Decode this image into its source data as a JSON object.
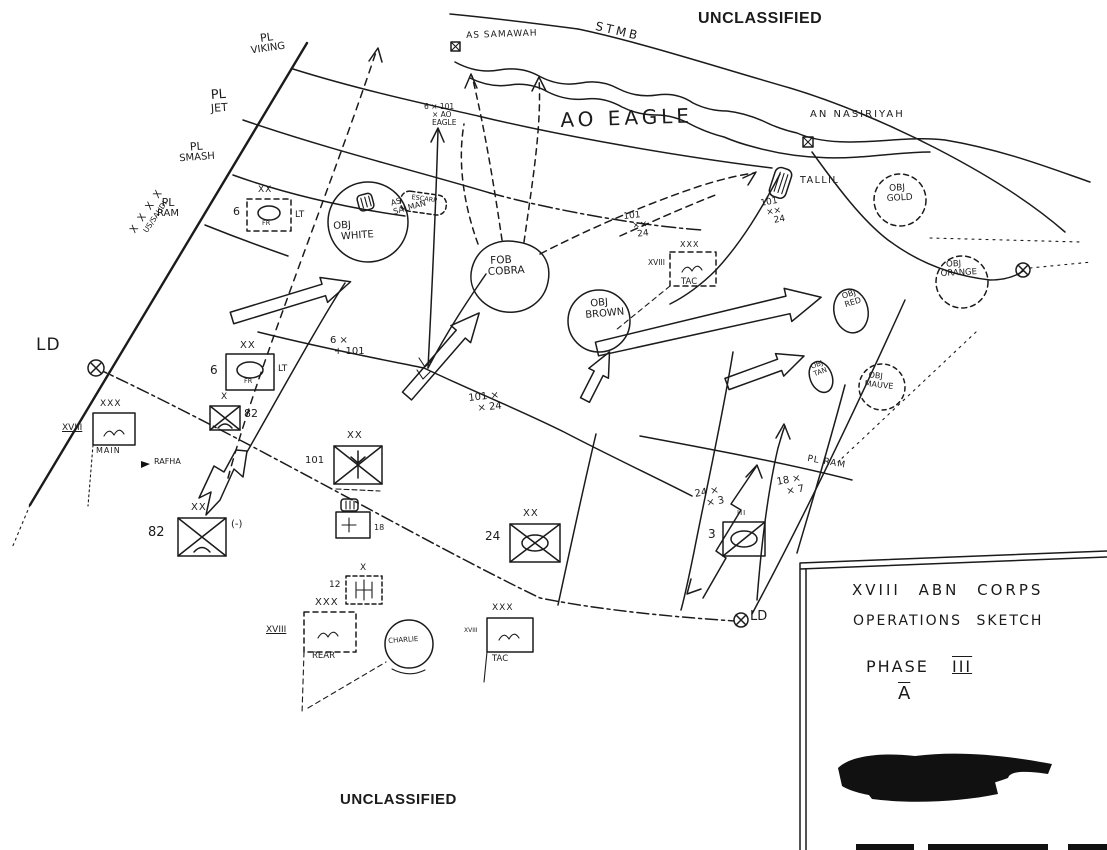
{
  "classification": {
    "top": "UNCLASSIFIED",
    "bottom": "UNCLASSIFIED"
  },
  "phase_lines": {
    "viking": {
      "l1": "PL",
      "l2": "VIKING"
    },
    "jet": {
      "l1": "PL",
      "l2": "JET"
    },
    "smash": {
      "l1": "PL",
      "l2": "SMASH"
    },
    "ram": {
      "l1": "PL",
      "l2": "RAM"
    },
    "ram_right": "PL RAM"
  },
  "control": {
    "ld_left": "LD",
    "ld_right": "LD",
    "us_saudi_echelon": "X X X X",
    "us_saudi": "US/SAUDI",
    "ao_eagle": "AO EAGLE"
  },
  "places": {
    "stmb": "STMB",
    "as_samawah": "AS SAMAWAH",
    "an_nasiriyah": "AN NASIRIYAH",
    "tallil": "TALLIL",
    "rafha": "RAFHA",
    "as_salman": {
      "l1": "AS",
      "l2": "SALMAN"
    },
    "escarp": "ESCARP"
  },
  "objectives": {
    "white": {
      "l1": "OBJ",
      "l2": "WHITE"
    },
    "cobra": {
      "l1": "FOB",
      "l2": "COBRA"
    },
    "brown": {
      "l1": "OBJ",
      "l2": "BROWN"
    },
    "red": {
      "l1": "OBJ",
      "l2": "RED"
    },
    "gold": {
      "l1": "OBJ",
      "l2": "GOLD"
    },
    "orange": {
      "l1": "OBJ",
      "l2": "ORANGE"
    },
    "tan": {
      "l1": "OBJ",
      "l2": "TAN"
    },
    "mauve": {
      "l1": "OBJ",
      "l2": "MAUVE"
    },
    "charlie": "CHARLIE"
  },
  "boundaries": {
    "fr_101_north": {
      "l1": "6 × 101",
      "l2": "× AO",
      "l3": "EAGLE"
    },
    "fr_101_mid": {
      "l1": "6 ×",
      "l2": "+ 101"
    },
    "a_101_24": {
      "l1": "101",
      "l2": "××",
      "l3": "24"
    },
    "b_101_24": {
      "l1": "101",
      "l2": "××",
      "l3": "24"
    },
    "c_101_24": {
      "l1": "101 ×",
      "l2": "× 24"
    },
    "d_24_3": {
      "l1": "24 ×",
      "l2": "× 3"
    },
    "e_18_7": {
      "l1": "18 ×",
      "l2": "× 7"
    }
  },
  "units": {
    "fr6_planned": {
      "num": "6",
      "echelon": "XX",
      "branch": "FR",
      "suffix": "LT"
    },
    "fr6": {
      "num": "6",
      "echelon": "XX",
      "branch": "FR",
      "suffix": "LT"
    },
    "bde82": {
      "num": "82",
      "echelon": "X"
    },
    "div82": {
      "num": "82",
      "echelon": "XX",
      "suffix": "(-)"
    },
    "div101": {
      "num": "101",
      "echelon": "XX"
    },
    "div24": {
      "num": "24",
      "echelon": "XX"
    },
    "avn12": {
      "num": "12",
      "echelon": "X"
    },
    "acr3": {
      "num": "3",
      "echelon": "III"
    },
    "unit18": {
      "num": "18"
    }
  },
  "command_posts": {
    "main": {
      "corps": "XVIII",
      "echelon": "XXX",
      "name": "MAIN"
    },
    "tac_forward": {
      "corps": "XVIII",
      "echelon": "XXX",
      "name": "TAC"
    },
    "tac": {
      "corps": "XVIII",
      "echelon": "XXX",
      "name": "TAC"
    },
    "rear": {
      "corps": "XVIII",
      "echelon": "XXX",
      "name": "REAR"
    }
  },
  "title_block": {
    "line1": "XVIII ABN CORPS",
    "line2": "OPERATIONS SKETCH",
    "line3_label": "PHASE",
    "line3_numeral": "III",
    "line4": "A"
  },
  "ink_color": "#1b1b1b"
}
